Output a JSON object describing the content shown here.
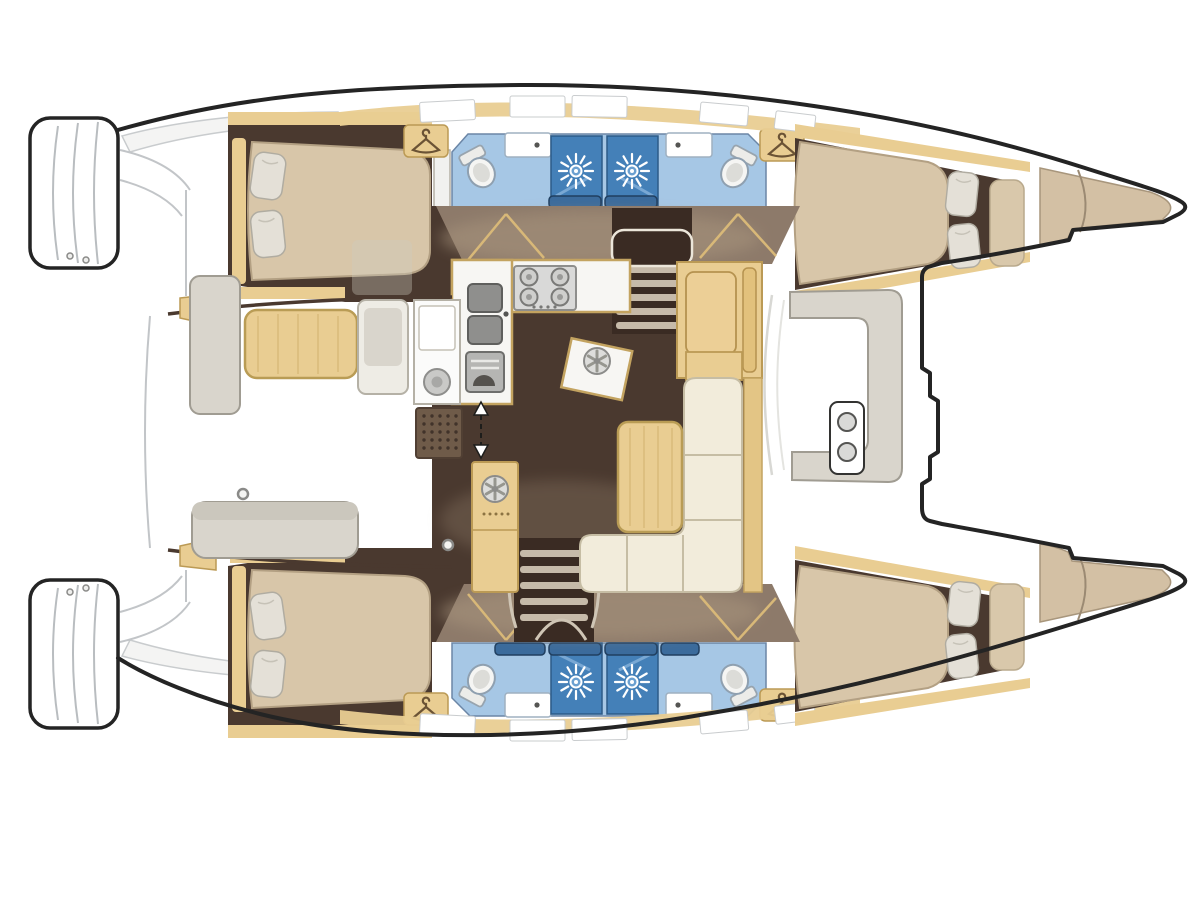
{
  "meta": {
    "description": "Top-down interior floor plan of a twin-hull sailing catamaran, bows pointing right, sterns with swim platforms at left",
    "diagram_type": "boat-layout-floor-plan",
    "text_on_image": "none"
  },
  "palette": {
    "hull_outline": "#242424",
    "deck_white": "#ffffff",
    "sketch_gray": "#c2c5c8",
    "wall_dark": "#4a392f",
    "cabin_floor": "#4a392f",
    "corridor": "#8d7a6a",
    "corridor_light": "#a8947d",
    "wood_tan": "#e9cd92",
    "wood_tan_dark": "#bb9a55",
    "bed_beige": "#d8c6a9",
    "bed_edge": "#b3a083",
    "bow_beige": "#d3c0a4",
    "pillow_gray": "#e4e0d7",
    "bath_floor_blue": "#a6c7e5",
    "shower_blue": "#4480b8",
    "shower_glass": "#79a8d4",
    "header_blue": "#3b6b9c",
    "sofa_cream": "#f2ecdb",
    "sofa_edge": "#c6bda4",
    "bench_gray": "#d9d5cc",
    "bench_edge": "#a09c92",
    "appliance_gray": "#d9d9d8",
    "appliance_dark": "#8e8e8c",
    "sink_gray": "#8f8f8d",
    "grate_brown": "#6f5b49",
    "window_white": "#ffffff"
  },
  "structure": {
    "orientation": {
      "bow": "right",
      "stern": "left",
      "upper_hull": "port",
      "lower_hull": "starboard"
    },
    "hull_rooms": [
      "aft double cabin with island berth and two pillows",
      "aft bathroom: tilted toilet, washbasin, hanging wardrobe",
      "two adjoining shower stalls with sunburst shower-rose symbol",
      "forward bathroom: washbasin, tilted toilet, hanging wardrobe",
      "forward double cabin: berth with two pillows plus seat cushion",
      "bow storage locker (beige) split by curved bulkhead line"
    ],
    "bridgedeck_rooms": [
      "saloon with dark floor",
      "U-shaped galley: 4-burner stove, double sink, oven, round hatch",
      "tall fridge cabinet with round hatch wheel",
      "companionway double-headed dashed arrow",
      "port and starboard companionway stairs with rail hoops",
      "L-shaped cream settee with wood table",
      "wood chart/nav cabinet",
      "aft cockpit: wood table, gray bench seats, wet bar with round sink and floor grate",
      "forward cockpit: C-shaped bench and twin cup-holder panel"
    ],
    "counts": {
      "cabins": 4,
      "double_berths": 4,
      "pillows": 8,
      "shower_stalls": 4,
      "toilets": 4,
      "bathroom_washbasins": 4,
      "hanging_wardrobes": 4,
      "stove_burners": 4,
      "galley_sink_bowls": 2,
      "round_hatch_wheels": 2,
      "cockpit_round_sink": 1,
      "stair_flights": 2,
      "stern_swim_platforms": 2,
      "cup_holders": 2
    }
  },
  "icons": [
    "sunburst-shower-icon",
    "clothes-hanger-icon",
    "toilet-icon",
    "stove-burner-icon",
    "double-sink-icon",
    "oven-icon",
    "hatch-wheel-icon",
    "companionway-arrow-icon",
    "cup-holder-icon",
    "pillow-icon",
    "floor-grate-icon",
    "stair-treads-icon"
  ]
}
